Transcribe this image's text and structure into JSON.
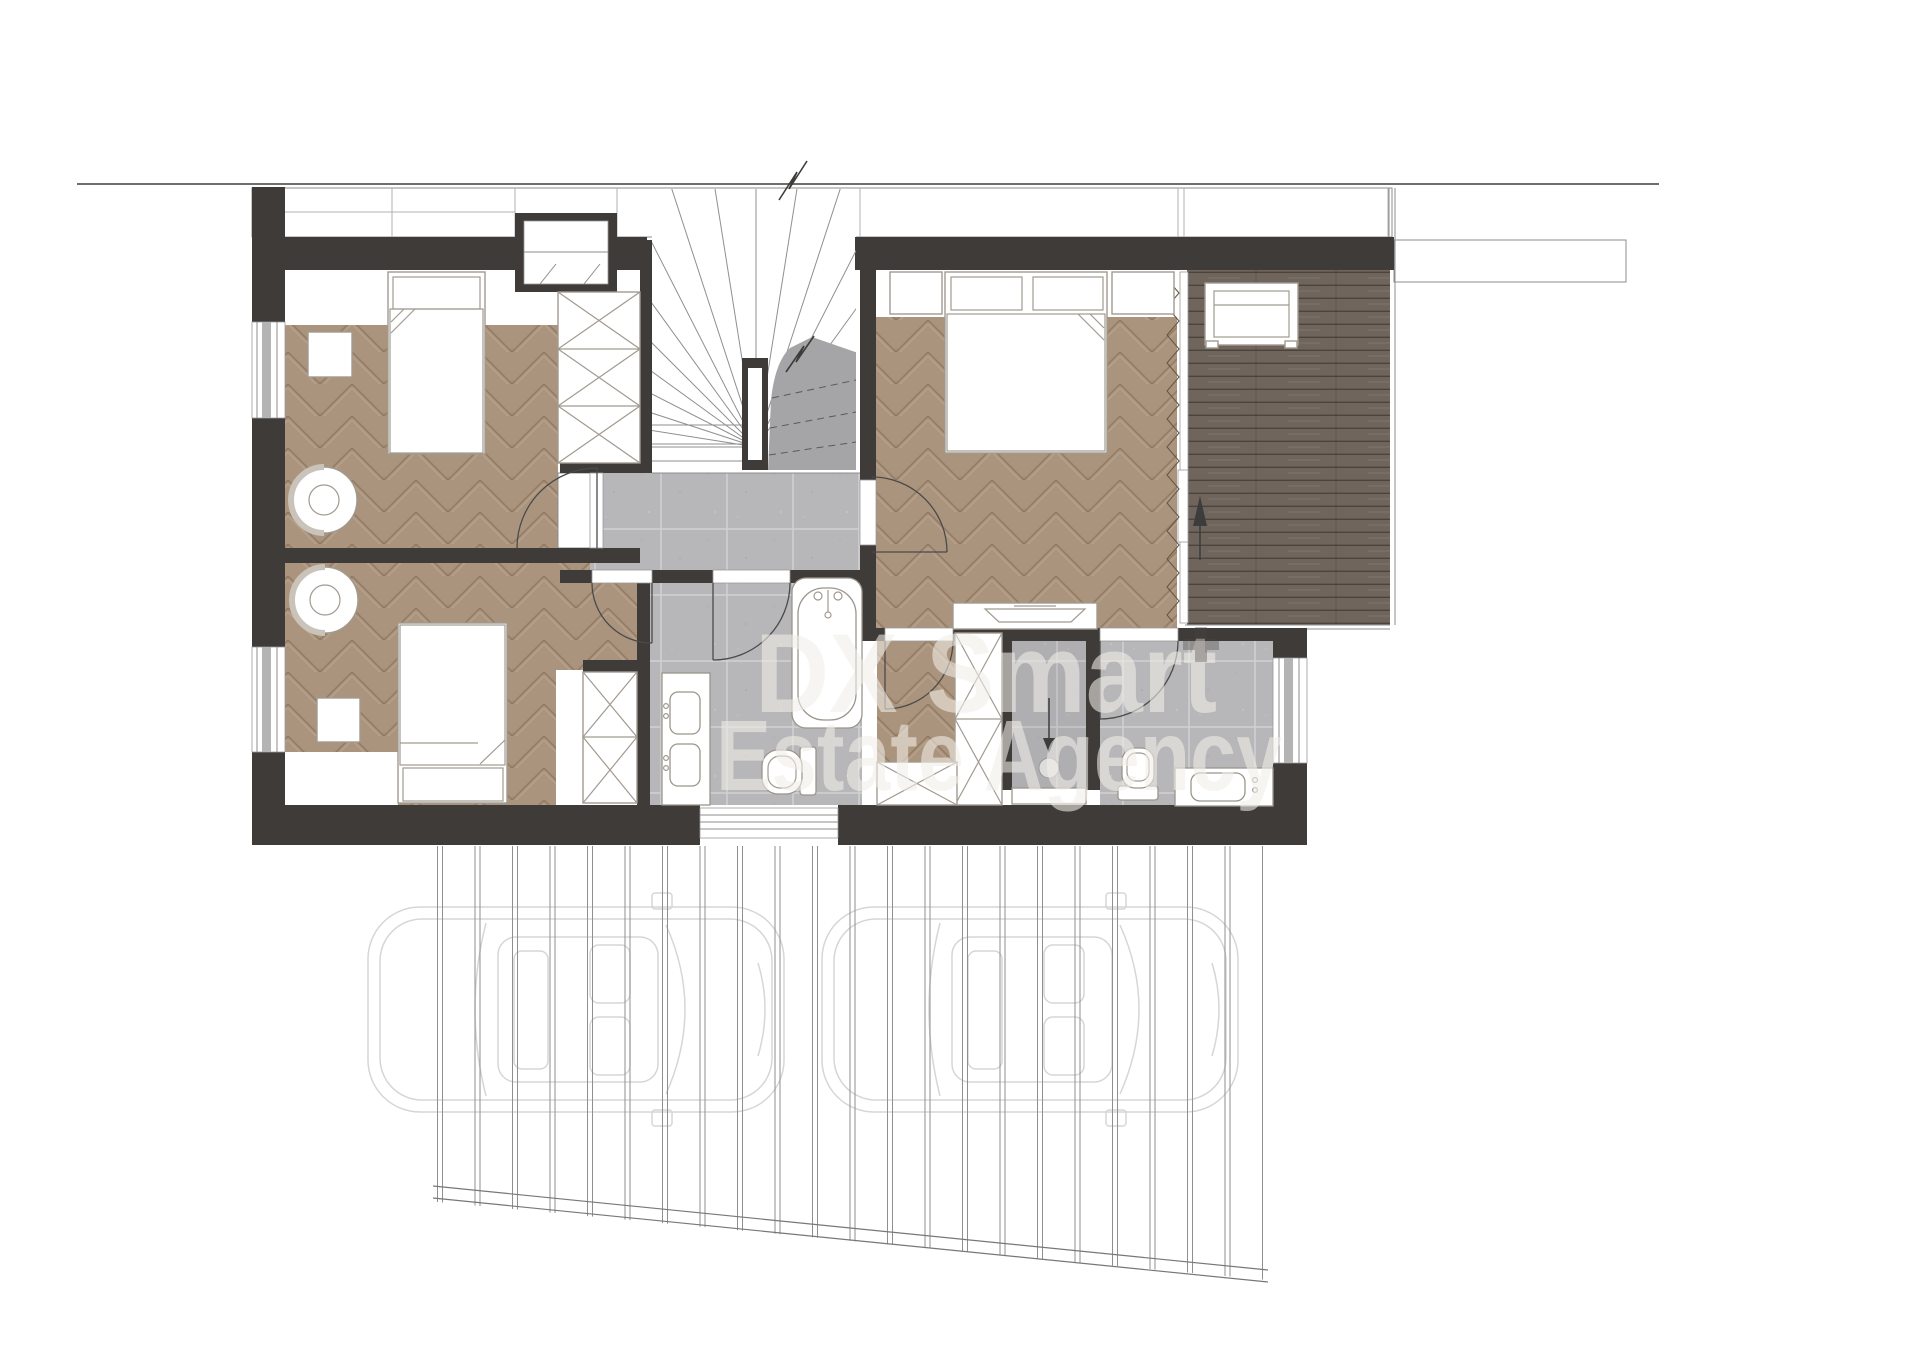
{
  "watermark": {
    "line1": "DX Smart",
    "line2": "Estate Agency"
  },
  "palette": {
    "wall": "#3e3b39",
    "parquet_base": "#ab947d",
    "parquet_line": "#7a5f45",
    "tile_base": "#b7b6b8",
    "tile_line": "#d2d1d3",
    "deck_base": "#6f655c",
    "deck_line": "#2e2822",
    "stair_gray": "#a5a4a6",
    "furniture_stroke": "#a19a90",
    "fixture_stroke": "#9b958b",
    "thin_line": "#8c8c8c",
    "car_stroke": "#d6d6d6",
    "watermark_color": "#f2efe9",
    "arrow_color": "#3c3c3c"
  }
}
